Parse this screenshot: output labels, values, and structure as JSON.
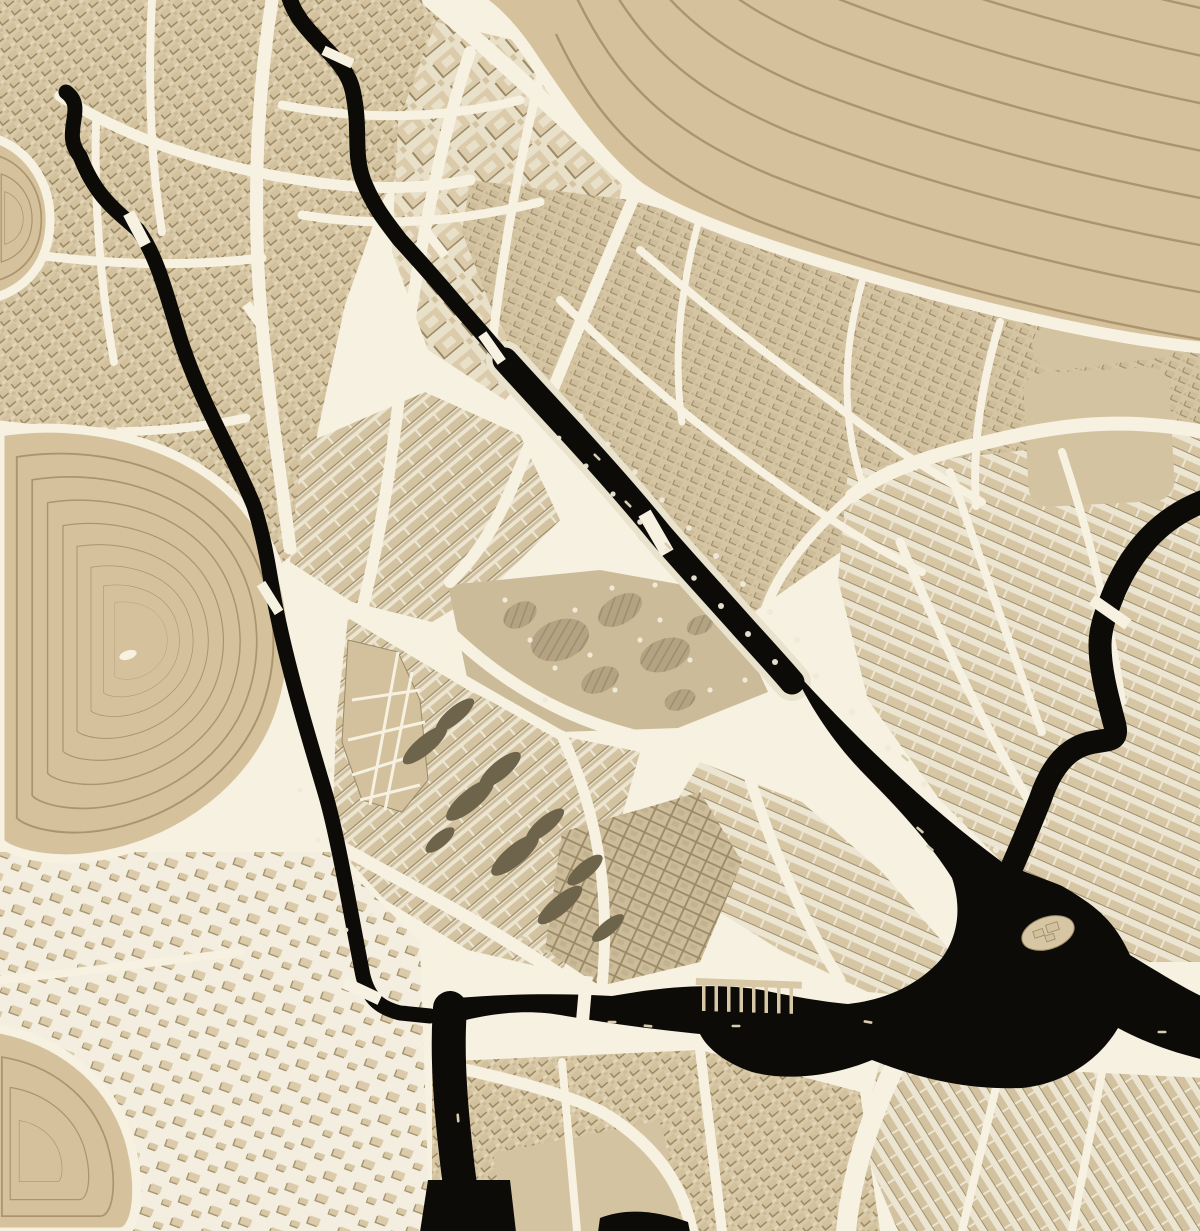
{
  "map": {
    "width": 1200,
    "height": 1231,
    "colors": {
      "street": "#f7f1e1",
      "water": "#0d0b08",
      "water_quay": "#e9e2cd",
      "terrain": "#d5c29c",
      "contour": "#a68f69",
      "block_base": "#d9c9a7",
      "block_building": "#d2c19c",
      "block_shadow": "#9a8a66",
      "park_base": "#cbbb98",
      "park_blob": "#b3a383",
      "dev_void": "#6e644b",
      "plaza": "#d4c3a0",
      "tree": "#efe9d7",
      "boat": "#d9cdb0",
      "pier": "#d8c8a6",
      "island": "#d6c6a4"
    },
    "zones": [
      {
        "name": "district-northwest-old-town",
        "pat": "pat-fine40",
        "d": "M0,0 L432,0 L470,52 L430,120 L380,205 L345,305 L318,430 L300,548 L240,598 L150,630 L60,562 L0,472 Z"
      },
      {
        "name": "district-garden-suburb",
        "pat": "pat-big40",
        "d": "M436,22 L548,48 L625,172 L600,290 L505,400 L428,350 L392,252 L398,122 Z"
      },
      {
        "name": "district-east-medieval",
        "pat": "pat-fine24",
        "d": "M470,180 L630,200 L835,258 L1012,308 L1098,332 L1082,425 L1000,472 L880,525 L788,588 L736,625 L640,540 L560,430 L492,310 L462,232 Z"
      },
      {
        "name": "district-rowhouses-west",
        "pat": "pat-rows40",
        "d": "M302,445 L425,392 L520,435 L560,520 L498,582 L432,622 L352,602 L290,562 Z"
      },
      {
        "name": "central-park",
        "fill": "#cbbb98",
        "d": "M448,585 L600,570 L722,592 L768,692 L678,728 L560,732 L468,682 Z"
      },
      {
        "name": "district-redevelopment-rows",
        "pat": "pat-rows40",
        "d": "M348,618 L468,690 L562,736 L640,752 L612,852 L562,972 L468,950 L385,900 L332,842 L336,722 Z"
      },
      {
        "name": "district-riverbend-crescent",
        "pat": "pat-rows24",
        "d": "M700,762 L802,802 L882,872 L948,948 L958,1000 L868,992 L780,950 L700,900 L658,832 Z"
      },
      {
        "name": "district-crosshatch-grid",
        "pat": "pat-grid25",
        "d": "M562,832 L700,792 L742,862 L700,962 L600,986 L545,950 Z"
      },
      {
        "name": "district-northeast-grid",
        "pat": "pat-rows24",
        "d": "M848,470 L1205,430 L1205,962 L1100,962 L1020,880 L940,800 L868,700 L838,580 Z"
      },
      {
        "name": "district-southeast-rows",
        "pat": "pat-rows60",
        "d": "M880,1062 L1205,1078 L1205,1231 L898,1231 L860,1140 Z"
      },
      {
        "name": "district-south-central",
        "pat": "pat-fine40",
        "d": "M432,1062 L700,1050 L860,1092 L880,1231 L432,1231 Z"
      },
      {
        "name": "district-southwest-sparse",
        "pat": "pat-sparse20",
        "d": "M0,852 L330,852 L420,942 L430,1231 L0,1231 Z"
      },
      {
        "name": "district-hill-foot",
        "pat": "pat-fine24",
        "d": "M1062,255 L1205,252 L1205,428 L1092,424 Z"
      }
    ],
    "plazas": [
      {
        "name": "plaza-east-esplanade",
        "x": 1026,
        "y": 370,
        "w": 146,
        "h": 134,
        "rx": 20,
        "rot": -3
      },
      {
        "name": "crescent-block",
        "x": 1032,
        "y": 316,
        "w": 152,
        "h": 48,
        "rx": 24,
        "rot": -7
      },
      {
        "name": "plaza-south-block",
        "x": 500,
        "y": 1136,
        "w": 172,
        "h": 98,
        "rx": 8,
        "rot": -11
      }
    ],
    "streets": [
      {
        "w": 13,
        "d": "M272,0 C258,90 254,180 258,268 C262,352 276,444 290,548"
      },
      {
        "w": 11,
        "d": "M60,96 C130,140 210,166 300,180 C360,190 420,190 470,180"
      },
      {
        "w": 9,
        "d": "M0,250 C90,264 180,268 262,258"
      },
      {
        "w": 9,
        "d": "M0,425 C85,436 170,434 246,418"
      },
      {
        "w": 8,
        "d": "M152,0 C148,76 150,156 162,232"
      },
      {
        "w": 8,
        "d": "M96,122 C94,200 100,282 114,362"
      },
      {
        "w": 9,
        "d": "M282,105 C360,120 440,120 520,100"
      },
      {
        "w": 9,
        "d": "M302,215 C380,228 460,222 540,202"
      },
      {
        "w": 12,
        "d": "M470,52 C440,140 418,256 402,372 C392,462 380,540 360,618"
      },
      {
        "w": 9,
        "d": "M548,48 C522,140 502,256 492,346"
      },
      {
        "w": 16,
        "d": "M430,0 C505,62 565,122 638,188 C762,238 902,282 1012,312 C1082,328 1150,340 1205,346"
      },
      {
        "w": 12,
        "d": "M638,188 C598,278 558,378 520,468 C492,538 470,562 450,582"
      },
      {
        "w": 14,
        "d": "M1205,432 C1100,412 1030,432 962,448 C902,464 872,480 852,496"
      },
      {
        "w": 10,
        "d": "M852,496 C802,540 772,580 762,622"
      },
      {
        "w": 12,
        "d": "M448,630 C520,700 600,736 702,748 C742,752 772,730 790,692"
      },
      {
        "w": 10,
        "d": "M362,620 C432,662 502,702 562,736"
      },
      {
        "w": 11,
        "d": "M562,736 C592,800 612,880 602,986"
      },
      {
        "w": 13,
        "d": "M332,842 C402,882 472,916 562,976 C602,996 642,1006 700,1016"
      },
      {
        "w": 11,
        "d": "M742,752 C762,822 792,902 840,980"
      },
      {
        "w": 8,
        "d": "M640,250 C700,302 762,352 832,402 C882,442 932,472 982,502"
      },
      {
        "w": 8,
        "d": "M560,300 C622,362 692,422 762,472 C822,516 872,546 922,572"
      },
      {
        "w": 7,
        "d": "M700,216 C682,282 672,352 682,422"
      },
      {
        "w": 7,
        "d": "M862,282 C842,352 842,422 862,482"
      },
      {
        "w": 8,
        "d": "M1000,322 C982,382 972,442 976,506"
      },
      {
        "w": 8,
        "d": "M950,472 C982,562 1012,652 1042,732"
      },
      {
        "w": 8,
        "d": "M1062,452 C1092,542 1112,632 1122,702"
      },
      {
        "w": 9,
        "d": "M900,542 C942,642 992,742 1042,822"
      },
      {
        "w": 12,
        "d": "M430,1062 C502,1077 562,1092 602,1112 C652,1142 682,1182 692,1231"
      },
      {
        "w": 20,
        "d": "M902,1052 C872,1110 852,1170 846,1231"
      },
      {
        "w": 8,
        "d": "M1002,1062 L962,1231"
      },
      {
        "w": 8,
        "d": "M1102,1072 L1072,1231"
      },
      {
        "w": 10,
        "d": "M700,1050 L722,1231"
      },
      {
        "w": 8,
        "d": "M562,1062 L577,1231"
      },
      {
        "w": 8,
        "d": "M0,980 C80,972 160,962 240,952"
      }
    ],
    "wedge": {
      "name": "shard-wedge-block",
      "d": "M348,640 L398,652 L420,700 L428,780 L402,812 L362,800 L342,742 Z",
      "cracks": [
        [
          352,
          700,
          420,
          690
        ],
        [
          348,
          740,
          425,
          722
        ],
        [
          352,
          775,
          425,
          752
        ],
        [
          360,
          800,
          420,
          785
        ],
        [
          398,
          652,
          370,
          805
        ],
        [
          412,
          672,
          385,
          810
        ]
      ]
    },
    "hills": [
      {
        "name": "hill-northeast",
        "type": "bands",
        "d": "M418,0 L1205,0 L1205,348 C1120,340 1010,316 900,285 C790,254 690,222 642,190 C600,160 560,100 532,58 C515,32 495,10 478,0 Z",
        "margin": "M478,0 C495,10 515,32 532,58 C560,100 600,160 642,190 C690,222 790,254 900,285 C1010,316 1120,340 1205,348",
        "base": "M556,34 C600,128 652,176 756,220 C880,268 1040,312 1205,340",
        "n": 11,
        "dx": 17,
        "dy": -44
      },
      {
        "name": "hill-west",
        "type": "rings",
        "d": "M0,432 C85,418 185,442 240,502 C292,560 302,642 282,706 C262,775 198,832 118,852 C55,868 8,852 0,842 Z",
        "cx": 140,
        "cy": 640,
        "scales": [
          0.88,
          0.77,
          0.66,
          0.55,
          0.45,
          0.35,
          0.26,
          0.18
        ],
        "pond": [
          128,
          655,
          9,
          4.5,
          -18
        ]
      },
      {
        "name": "hill-northwest-corner",
        "type": "rings",
        "d": "M-6,138 C30,150 52,185 50,225 C48,262 28,288 -6,298 Z",
        "cx": 10,
        "cy": 218,
        "scales": [
          0.78,
          0.55,
          0.33
        ]
      },
      {
        "name": "hill-southwest-corner",
        "type": "rings",
        "d": "M-6,1028 C55,1038 108,1076 128,1136 C144,1188 136,1232 120,1232 L-6,1232 Z",
        "cx": 30,
        "cy": 1160,
        "scales": [
          0.78,
          0.55,
          0.3
        ]
      }
    ],
    "park": {
      "blobs": [
        [
          560,
          640,
          30,
          20,
          -20
        ],
        [
          620,
          610,
          24,
          14,
          -30
        ],
        [
          665,
          655,
          26,
          16,
          -20
        ],
        [
          600,
          680,
          20,
          12,
          -25
        ],
        [
          680,
          700,
          16,
          10,
          -20
        ],
        [
          520,
          615,
          18,
          12,
          -30
        ],
        [
          700,
          625,
          14,
          9,
          -25
        ]
      ],
      "trees": [
        [
          505,
          600
        ],
        [
          530,
          640
        ],
        [
          555,
          668
        ],
        [
          590,
          655
        ],
        [
          615,
          690
        ],
        [
          640,
          640
        ],
        [
          660,
          620
        ],
        [
          690,
          660
        ],
        [
          710,
          690
        ],
        [
          575,
          610
        ],
        [
          545,
          700
        ],
        [
          612,
          588
        ],
        [
          655,
          585
        ],
        [
          735,
          640
        ],
        [
          745,
          680
        ]
      ]
    },
    "dev_voids": [
      [
        425,
        745,
        28,
        9,
        -40
      ],
      [
        455,
        715,
        24,
        8,
        -40
      ],
      [
        470,
        800,
        30,
        10,
        -40
      ],
      [
        500,
        770,
        26,
        9,
        -40
      ],
      [
        515,
        855,
        30,
        10,
        -40
      ],
      [
        545,
        825,
        24,
        8,
        -40
      ],
      [
        560,
        905,
        28,
        9,
        -40
      ],
      [
        585,
        870,
        22,
        8,
        -40
      ],
      [
        608,
        928,
        20,
        7,
        -40
      ],
      [
        440,
        840,
        18,
        7,
        -40
      ]
    ],
    "rivers": {
      "underlays": [
        {
          "w": 38,
          "d": "M505,360 C532,390 562,422 582,444 C612,477 638,507 660,534 C684,562 710,590 734,617 C758,644 775,662 792,682"
        }
      ],
      "strokes": [
        {
          "name": "river-west",
          "w": 15,
          "d": "M66,92 C88,108 60,132 80,156 C96,198 118,212 138,230 C156,254 166,292 178,332 C198,398 232,452 254,506 C266,544 269,572 275,604 C289,674 309,738 326,796 C339,842 351,916 363,976 C369,1000 381,1008 400,1013 L430,1016"
        },
        {
          "name": "canal-north",
          "w": 16,
          "d": "M288,-8 C296,34 346,54 353,92 C361,130 353,152 363,180 C374,208 388,224 400,240 C424,266 443,288 460,308 C482,333 494,347 505,360"
        },
        {
          "name": "canal-treelined",
          "w": 25,
          "d": "M505,360 C532,390 562,422 582,444 C612,477 638,507 660,534 C684,562 710,590 734,617 C758,644 775,662 792,682"
        },
        {
          "name": "river-east",
          "w": 23,
          "d": "M1207,500 C1165,515 1135,545 1115,590 C1106,612 1100,628 1100,645 C1100,668 1106,692 1114,722 C1126,762 1070,710 1040,800 C1020,850 1014,862 1008,876"
        },
        {
          "name": "river-south-branch",
          "w": 34,
          "d": "M450,1008 C446,1060 452,1120 458,1170 C462,1200 464,1215 462,1232"
        }
      ],
      "fills": [
        {
          "name": "river-bend",
          "d": "M792,668 C856,738 926,806 1002,862 C1028,874 1048,880 1062,886 C1096,906 1114,920 1130,955 C1158,972 1184,988 1205,998 L1205,1060 C1170,1052 1140,1040 1118,1028 C1098,1062 1062,1084 1022,1088 C966,1090 918,1078 872,1060 C836,1075 790,1082 752,1072 C722,1062 706,1046 700,1034 C660,1030 612,1024 566,1016 C526,1008 488,1014 458,1022 C444,1016 442,1004 456,998 C505,994 560,993 612,996 C668,986 716,983 762,990 C800,998 826,1002 848,1004 C886,1000 920,984 942,958 C958,936 962,908 952,878 C932,846 902,812 868,778 C838,748 812,712 792,668 Z"
        },
        {
          "name": "river-bottom-widening",
          "d": "M428,1180 L510,1180 L516,1232 L420,1232 Z"
        },
        {
          "name": "canal-south-stub",
          "d": "M598,1232 L600,1218 C625,1208 655,1210 688,1222 L690,1232 Z"
        }
      ]
    },
    "bridges": [
      [
        137,
        229,
        62,
        36,
        12
      ],
      [
        256,
        318,
        55,
        34,
        10
      ],
      [
        270,
        598,
        58,
        34,
        10
      ],
      [
        362,
        991,
        25,
        40,
        12
      ],
      [
        338,
        57,
        25,
        32,
        10
      ],
      [
        436,
        244,
        52,
        30,
        9
      ],
      [
        492,
        348,
        55,
        34,
        10
      ],
      [
        656,
        533,
        60,
        46,
        14
      ],
      [
        584,
        1004,
        95,
        56,
        13
      ],
      [
        1110,
        612,
        35,
        44,
        12
      ]
    ],
    "trees": [
      [
        581,
        416,
        2.6
      ],
      [
        608,
        444,
        2.6
      ],
      [
        635,
        472,
        2.8
      ],
      [
        662,
        500,
        2.8
      ],
      [
        689,
        528,
        2.8
      ],
      [
        716,
        556,
        3
      ],
      [
        743,
        584,
        3
      ],
      [
        770,
        612,
        3
      ],
      [
        797,
        640,
        3
      ],
      [
        559,
        438,
        2.4
      ],
      [
        586,
        466,
        2.6
      ],
      [
        613,
        494,
        2.6
      ],
      [
        640,
        522,
        2.8
      ],
      [
        667,
        550,
        2.8
      ],
      [
        694,
        578,
        2.8
      ],
      [
        721,
        606,
        3
      ],
      [
        748,
        634,
        3
      ],
      [
        775,
        662,
        3
      ],
      [
        816,
        676,
        3
      ],
      [
        852,
        712,
        3
      ],
      [
        888,
        748,
        3.2
      ],
      [
        924,
        784,
        3.2
      ],
      [
        960,
        820,
        3.2
      ],
      [
        996,
        850,
        3.2
      ],
      [
        300,
        790,
        2.4
      ],
      [
        318,
        840,
        2.4
      ],
      [
        332,
        885,
        2.4
      ],
      [
        346,
        930,
        2.4
      ],
      [
        330,
        770,
        2.4
      ],
      [
        345,
        820,
        2.4
      ],
      [
        358,
        868,
        2.4
      ],
      [
        372,
        915,
        2.4
      ]
    ],
    "boats": [
      [
        228,
        352,
        40
      ],
      [
        112,
        428,
        5
      ],
      [
        524,
        938,
        25
      ],
      [
        548,
        952,
        25
      ],
      [
        612,
        1022,
        0
      ],
      [
        648,
        1026,
        5
      ],
      [
        736,
        1026,
        0
      ],
      [
        868,
        1022,
        10
      ],
      [
        948,
        792,
        40
      ],
      [
        905,
        758,
        40
      ],
      [
        1078,
        714,
        80
      ],
      [
        458,
        1118,
        85
      ],
      [
        1162,
        1032,
        0
      ],
      [
        668,
        546,
        45
      ],
      [
        597,
        457,
        45
      ],
      [
        628,
        504,
        45
      ],
      [
        920,
        830,
        40
      ],
      [
        930,
        848,
        40
      ]
    ],
    "piers": {
      "bar": [
        696,
        978,
        106,
        7,
        2
      ],
      "piles": {
        "x0": 702,
        "y0": 985,
        "dx": 12.5,
        "dy": 0.4,
        "n": 8,
        "w": 3.5,
        "h": 26
      }
    },
    "island": {
      "cx": 1048,
      "cy": 933,
      "rot": -18,
      "rx": 27,
      "ry": 16,
      "bldgs": [
        [
          -14,
          -6,
          10,
          7
        ],
        [
          0,
          -8,
          12,
          8
        ],
        [
          -4,
          2,
          9,
          6
        ]
      ]
    }
  }
}
